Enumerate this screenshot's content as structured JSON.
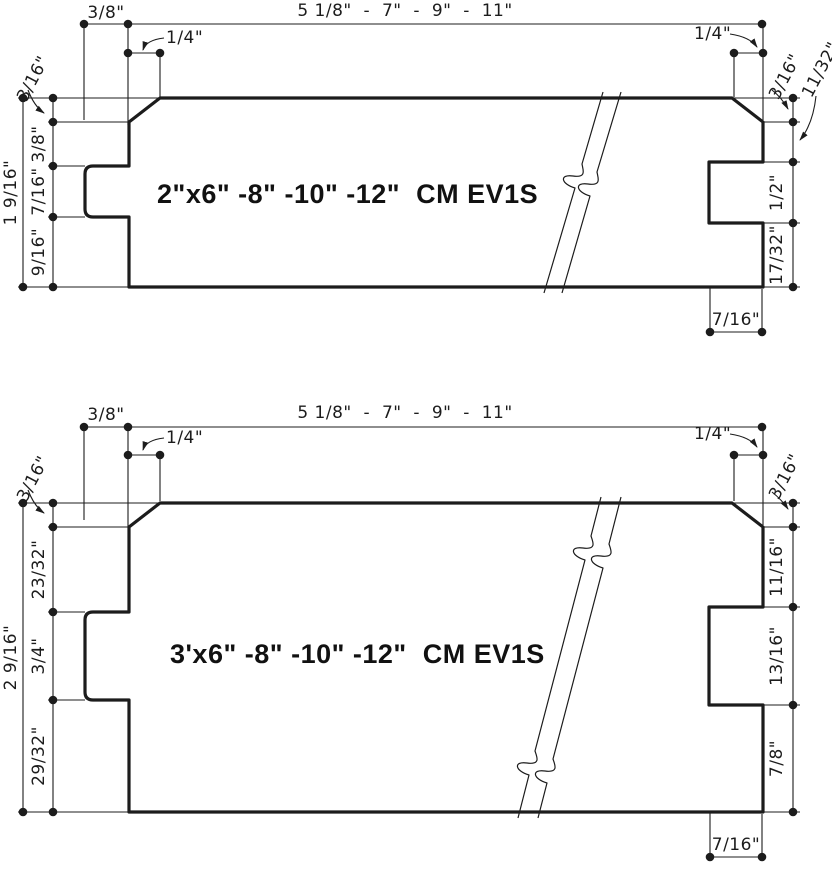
{
  "sheet": {
    "background": "#ffffff",
    "line_color": "#1c1c1c"
  },
  "drawings": [
    {
      "title": "2\"x6\" -8\" -10\" -12\"  CM EV1S",
      "top": {
        "setback": "3/8\"",
        "chamfer_left": "1/4\"",
        "widths": "5 1/8\"  -  7\"  -  9\"  -  11\"",
        "chamfer_right": "1/4\""
      },
      "left": {
        "overall": "1 9/16\"",
        "segments": [
          "3/16\"",
          "3/8\"",
          "7/16\"",
          "9/16\""
        ]
      },
      "right": {
        "segments": [
          "3/16\"",
          "11/32\"",
          "1/2\"",
          "17/32\""
        ],
        "groove_depth": "7/16\""
      }
    },
    {
      "title": "3'x6\" -8\" -10\" -12\"  CM EV1S",
      "top": {
        "setback": "3/8\"",
        "chamfer_left": "1/4\"",
        "widths": "5 1/8\"  -  7\"  -  9\"  -  11\"",
        "chamfer_right": "1/4\""
      },
      "left": {
        "overall": "2 9/16\"",
        "segments": [
          "3/16\"",
          "23/32\"",
          "3/4\"",
          "29/32\""
        ]
      },
      "right": {
        "segments": [
          "3/16\"",
          "11/16\"",
          "13/16\"",
          "7/8\""
        ],
        "groove_depth": "7/16\""
      }
    }
  ]
}
